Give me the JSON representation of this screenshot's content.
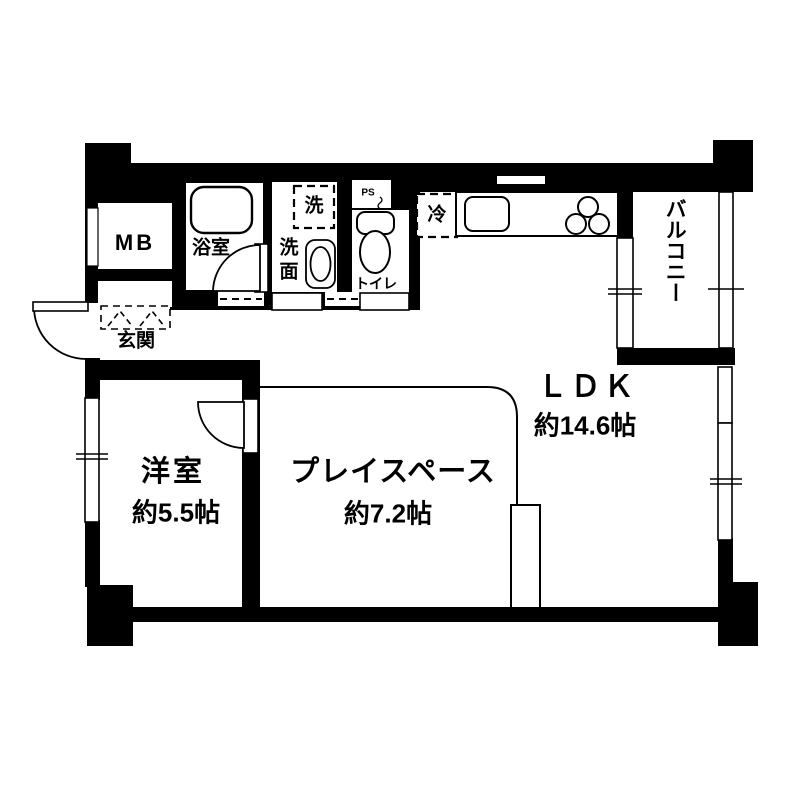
{
  "title": "間取り図",
  "rooms": {
    "ldk": {
      "label": "ＬＤＫ",
      "area": "約14.6帖"
    },
    "play_space": {
      "label": "プレイスペース",
      "area": "約7.2帖"
    },
    "western_room": {
      "label": "洋室",
      "area": "約5.5帖"
    },
    "balcony": {
      "label": "バルコニー"
    },
    "entrance": {
      "label": "玄関"
    },
    "bathroom": {
      "label": "浴室"
    },
    "washroom": {
      "label": "洗面"
    },
    "toilet": {
      "label": "トイレ"
    },
    "meter_box": {
      "label": "MB"
    },
    "pipe_space": {
      "label": "PS"
    }
  },
  "fixtures": {
    "refrigerator_label": "冷",
    "washing_machine_label": "洗"
  },
  "colors": {
    "wall": "#000000",
    "floor": "#ffffff",
    "line": "#000000"
  }
}
